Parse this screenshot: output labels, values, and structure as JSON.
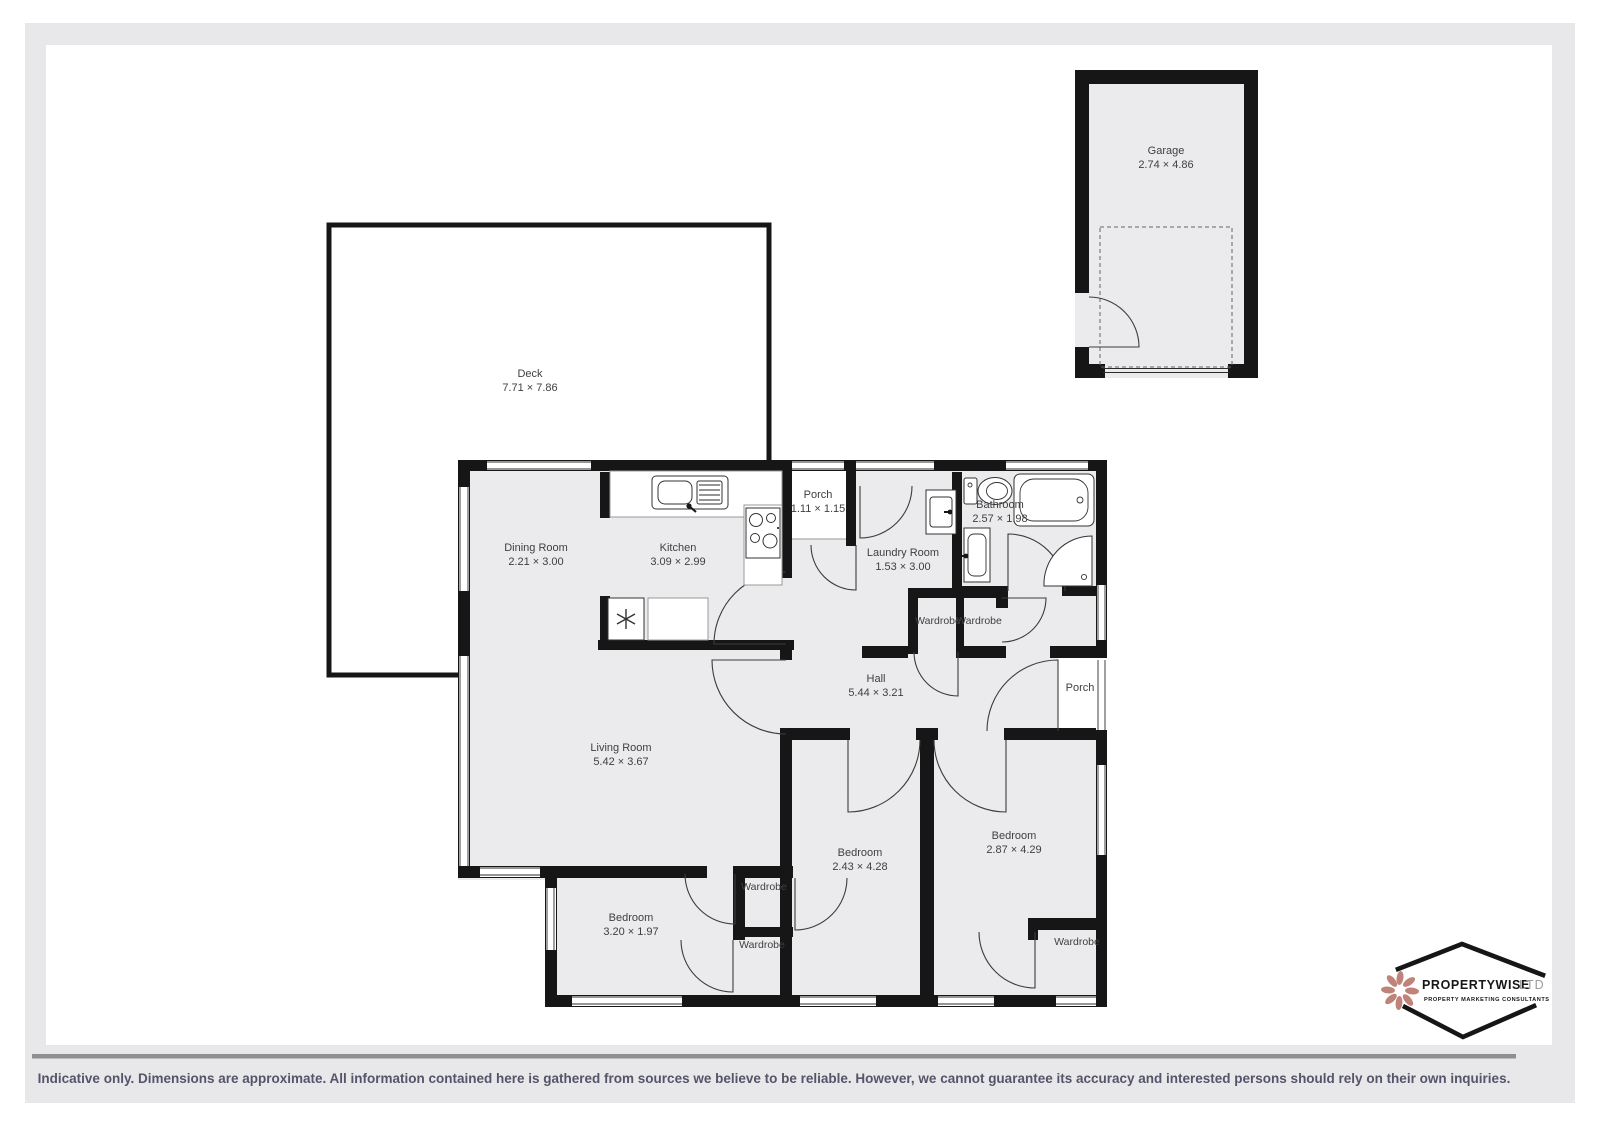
{
  "page": {
    "disclaimer": "Indicative only. Dimensions are approximate. All information contained here is gathered from sources we believe to be reliable. However, we cannot guarantee its accuracy and interested persons should rely on their own inquiries.",
    "colors": {
      "frame": "#e8e8ea",
      "panel": "#ffffff",
      "wall": "#161616",
      "room_fill": "#ebebed",
      "divider": "#8f8f8f",
      "label_text": "#3f3f3f",
      "disclaimer_text": "#54546a",
      "logo_accent": "#c0837a"
    }
  },
  "logo": {
    "brand": "PROPERTYWISE",
    "suffix": "LTD",
    "tagline": "PROPERTY MARKETING CONSULTANTS",
    "icon": "flower-petal-icon"
  },
  "rooms": [
    {
      "name": "Deck",
      "dims": "7.71 × 7.86"
    },
    {
      "name": "Garage",
      "dims": "2.74 × 4.86"
    },
    {
      "name": "Dining Room",
      "dims": "2.21 × 3.00"
    },
    {
      "name": "Kitchen",
      "dims": "3.09 × 2.99"
    },
    {
      "name": "Porch",
      "dims": "1.11 × 1.15"
    },
    {
      "name": "Laundry Room",
      "dims": "1.53 × 3.00"
    },
    {
      "name": "Bathroom",
      "dims": "2.57 × 1.98"
    },
    {
      "name": "Wardrobe",
      "dims": ""
    },
    {
      "name": "Wardrobe",
      "dims": ""
    },
    {
      "name": "Hall",
      "dims": "5.44 × 3.21"
    },
    {
      "name": "Porch",
      "dims": ""
    },
    {
      "name": "Living Room",
      "dims": "5.42 × 3.67"
    },
    {
      "name": "Bedroom",
      "dims": "3.20 × 1.97"
    },
    {
      "name": "Wardrobe",
      "dims": ""
    },
    {
      "name": "Wardrobe",
      "dims": ""
    },
    {
      "name": "Bedroom",
      "dims": "2.43 × 4.28"
    },
    {
      "name": "Bedroom",
      "dims": "2.87 × 4.29"
    },
    {
      "name": "Wardrobe",
      "dims": ""
    }
  ]
}
